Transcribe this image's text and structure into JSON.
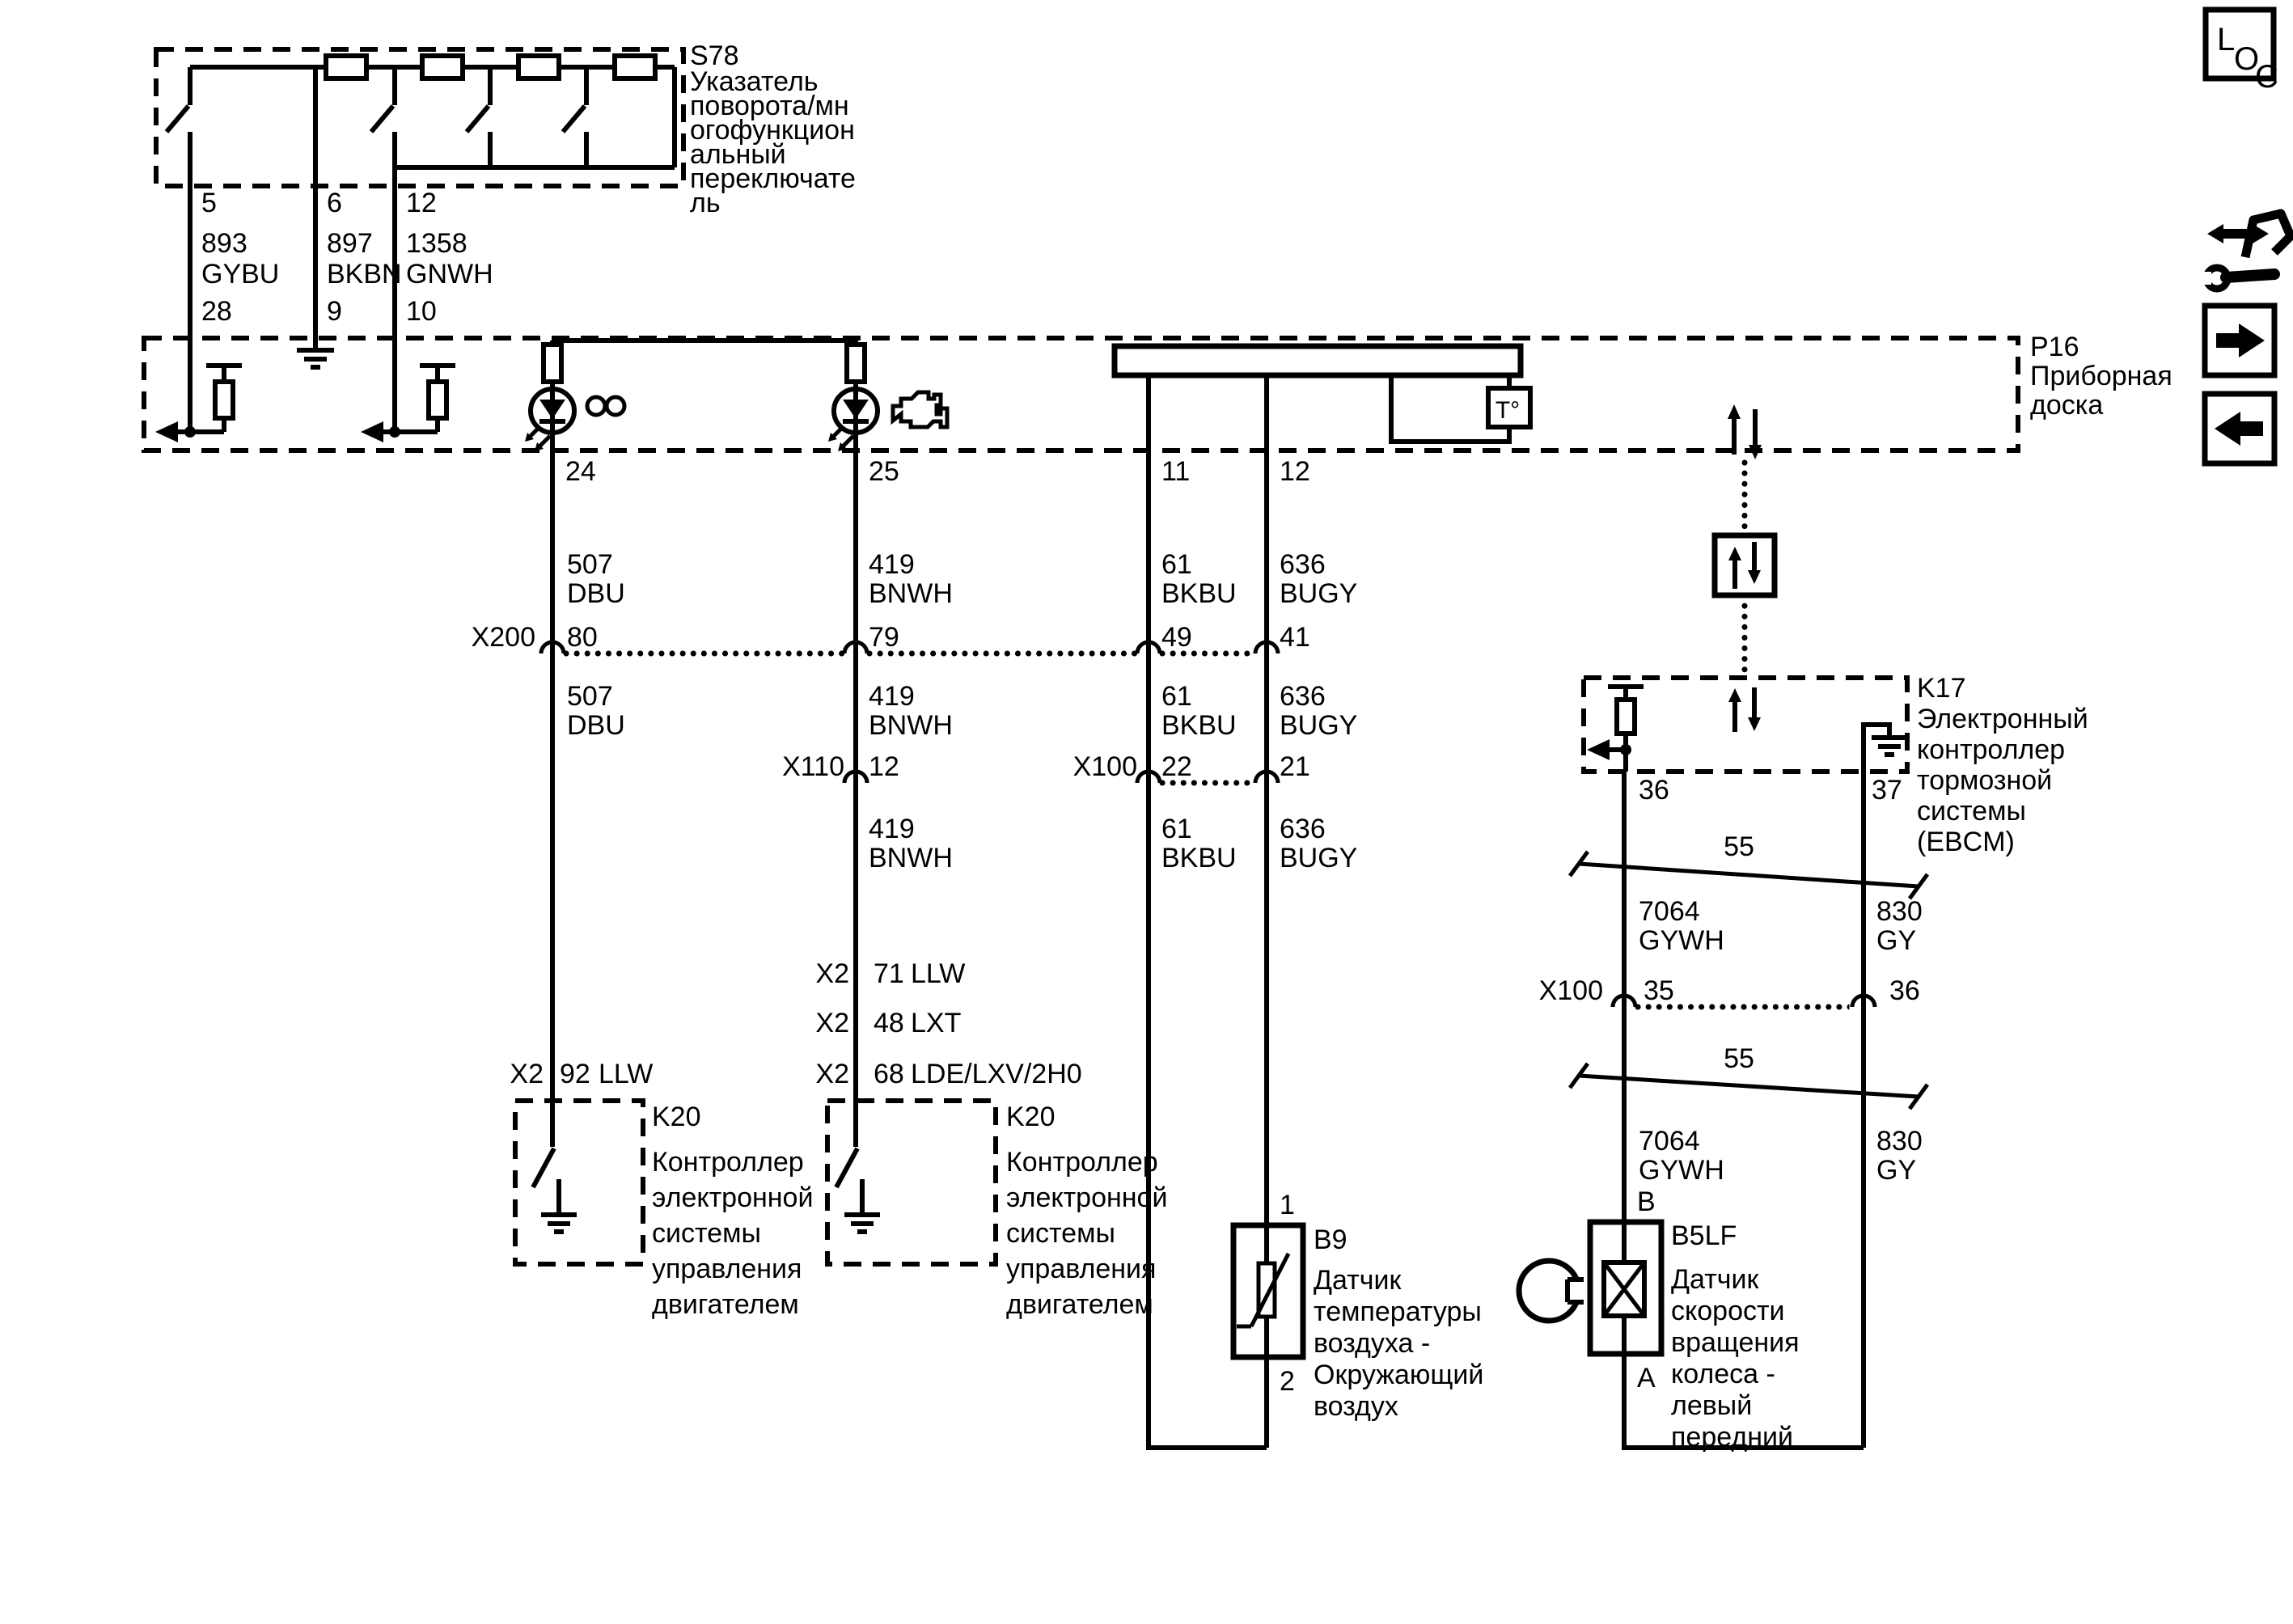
{
  "s78": {
    "id": "S78",
    "desc": [
      "Указатель",
      "поворота/мн",
      "огофункцион",
      "альный",
      "переключате",
      "ль"
    ]
  },
  "feeds": [
    {
      "circuit": "893",
      "color": "GYBU",
      "s78_pin": "5",
      "p16_pin": "28"
    },
    {
      "circuit": "897",
      "color": "BKBN",
      "s78_pin": "6",
      "p16_pin": "9"
    },
    {
      "circuit": "1358",
      "color": "GNWH",
      "s78_pin": "12",
      "p16_pin": "10"
    }
  ],
  "p16": {
    "id": "P16",
    "desc": [
      "Приборная",
      "доска"
    ],
    "temp": "T°",
    "pins": [
      "24",
      "25",
      "11",
      "12"
    ]
  },
  "x200": {
    "label": "X200",
    "pins": [
      "80",
      "79",
      "49",
      "41"
    ]
  },
  "x110": {
    "label": "X110",
    "pin": "12"
  },
  "x100_eng": {
    "label": "X100",
    "pins": [
      "22",
      "21"
    ]
  },
  "x100_abs": {
    "label": "X100",
    "pins": [
      "35",
      "36"
    ]
  },
  "wires": {
    "w507": {
      "num": "507",
      "color": "DBU"
    },
    "w419": {
      "num": "419",
      "color": "BNWH"
    },
    "w61": {
      "num": "61",
      "color": "BKBU"
    },
    "w636": {
      "num": "636",
      "color": "BUGY"
    },
    "w7064": {
      "num": "7064",
      "color": "GYWH"
    },
    "w830": {
      "num": "830",
      "color": "GY"
    }
  },
  "x2_left": {
    "conn": "X2",
    "pin": "92",
    "eng": "LLW"
  },
  "x2_right": [
    {
      "conn": "X2",
      "pin": "71",
      "eng": "LLW"
    },
    {
      "conn": "X2",
      "pin": "48",
      "eng": "LXT"
    },
    {
      "conn": "X2",
      "pin": "68",
      "eng": "LDE/LXV/2H0"
    }
  ],
  "k20": {
    "id": "K20",
    "desc": [
      "Контроллер",
      "электронной",
      "системы",
      "управления",
      "двигателем"
    ]
  },
  "k17": {
    "id": "K17",
    "desc": [
      "Электронный",
      "контроллер",
      "тормозной",
      "системы",
      "(EBCM)"
    ],
    "pins": [
      "36",
      "37"
    ]
  },
  "b9": {
    "id": "B9",
    "pin_1": "1",
    "pin_2": "2",
    "desc": [
      "Датчик",
      "температуры",
      "воздуха -",
      "Окружающий",
      "воздух"
    ]
  },
  "b5lf": {
    "id": "B5LF",
    "pin_b": "B",
    "pin_a": "A",
    "desc": [
      "Датчик",
      "скорости",
      "вращения",
      "колеса -",
      "левый",
      "передний"
    ]
  },
  "shield": {
    "label": "55"
  },
  "loc": {
    "l": "L",
    "o": "O",
    "c": "C"
  },
  "colors": {
    "ink": "#000000",
    "paper": "#ffffff"
  }
}
